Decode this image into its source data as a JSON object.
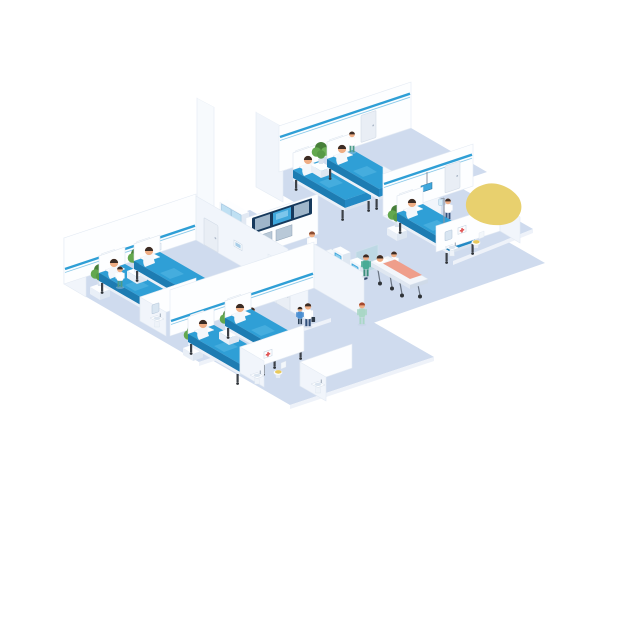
{
  "scene": {
    "type": "isometric-hospital-floor-illustration",
    "background": "#ffffff",
    "palette": {
      "floor": "#cfdbee",
      "wall": "#fdfeff",
      "wall_shade": "#f1f5fb",
      "wall_stripe": "#2f9fd6",
      "bed_blue": "#2f9fd6",
      "bed_blue_dark": "#1d7cb2",
      "screen_blue": "#3fa7dc",
      "desk_navy": "#2a5a96",
      "desk_navy_dark": "#1d4270",
      "plant_green": "#579a47",
      "plant_green_dark": "#477f39",
      "skin": "#efad84",
      "hair_dark": "#3b2c25",
      "scrub_teal": "#49ab96",
      "nurse_green": "#a9d7c6",
      "pants_navy": "#33507a",
      "orange": "#f0973f",
      "blue_shirt": "#4b8fd2",
      "yellow_accent": "#e8d06e",
      "toilet_lid": "#e8c95c",
      "glass": "#a9d6da",
      "shadow": "#c3d0e4"
    },
    "lobby": {
      "reception_desk": {
        "sign": "PSH",
        "staff": 1
      },
      "check_in_kiosks": 2,
      "kiosk_users": 2,
      "display_wall_screens": 3,
      "aux_monitors": 2,
      "supply_cabinet": true,
      "supply_staff": 1,
      "glass_partition": true,
      "stretcher": {
        "patient": 1,
        "attendant": 1,
        "escort": 1
      },
      "walking_people": [
        "doctor-with-bag",
        "child",
        "nurse"
      ]
    },
    "wards": [
      {
        "id": "top",
        "beds": 2,
        "patients": 2,
        "nurses": 1,
        "plants": 1,
        "wall_panels": 2,
        "door": true
      },
      {
        "id": "left",
        "beds": 2,
        "patients": 2,
        "nurses": 1,
        "plants": 2,
        "wall_panels": 2,
        "wall_art": true
      },
      {
        "id": "bottom",
        "beds": 2,
        "patients": 2,
        "nurses": 1,
        "plants": 2,
        "wall_panels": 2,
        "door": true
      },
      {
        "id": "right",
        "beds": 1,
        "patients": 1,
        "nurses": 1,
        "plants": 1,
        "wall_panels": 1,
        "iv_stand": true,
        "door": true
      }
    ],
    "bathrooms": [
      {
        "id": "left-wing",
        "sink": true,
        "toilet": true,
        "mirror": true
      },
      {
        "id": "bottom",
        "sink": true,
        "toilet": true,
        "wall_art": true
      },
      {
        "id": "right",
        "sink": true,
        "toilet": true,
        "mirror": true,
        "wall_art": true
      },
      {
        "id": "corridor",
        "sink": true
      },
      {
        "id": "south",
        "sink": true
      }
    ],
    "accent_shape": {
      "type": "yellow-blob",
      "position": "upper-right"
    }
  }
}
